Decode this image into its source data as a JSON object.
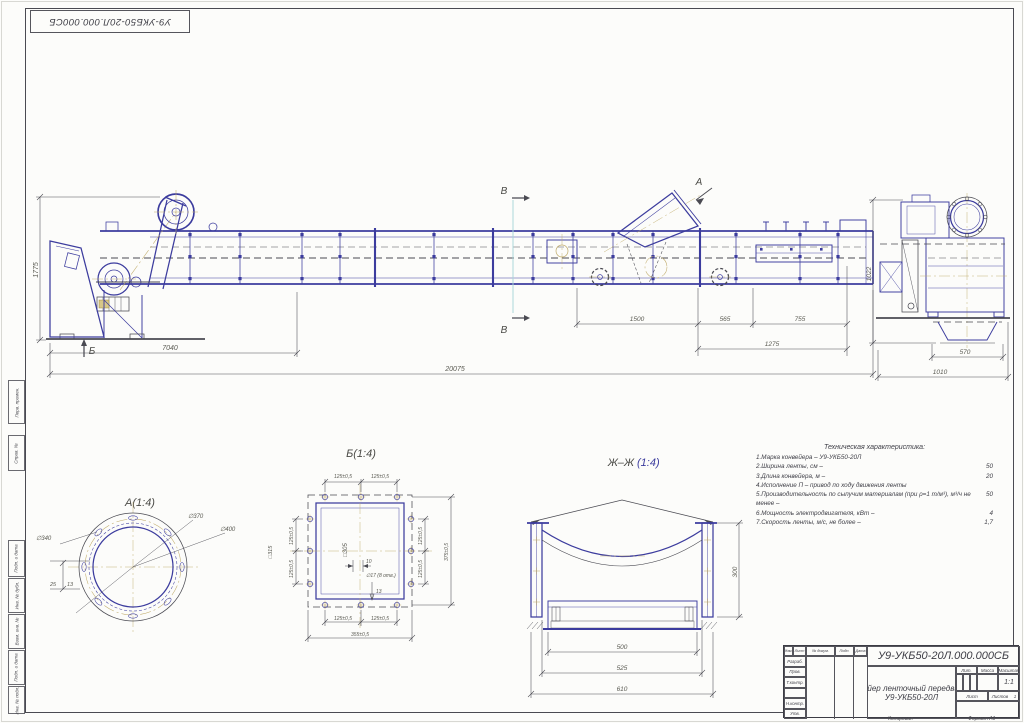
{
  "corner_stamp": {
    "number": "У9-УКБ50-20Л.000.000СБ"
  },
  "margin_stamps": [
    "Перв. примен.",
    "Справ. №",
    "Подп. и дата",
    "Инв. № дубл.",
    "Взам. инв. №",
    "Подп. и дата",
    "Инв. № подл."
  ],
  "main_view": {
    "label_a": "А",
    "label_b": "Б",
    "label_v_top": "В",
    "label_v_bottom": "В",
    "dim_drive": "7040",
    "dim_total": "20075",
    "dim_height": "1775",
    "dim_hopper1": "1500",
    "dim_hopper2": "565",
    "dim_tail": "755",
    "dim_tail_total": "1275"
  },
  "end_view": {
    "dim_height": "1022",
    "dim_width1": "570",
    "dim_width2": "1010"
  },
  "detail_a": {
    "title": "А(1:4)",
    "dia_bolt": "∅340",
    "dia_mid": "∅370",
    "dia_outer": "∅400",
    "dim_s1": "25",
    "dim_s2": "13"
  },
  "detail_b": {
    "title": "Б(1:4)",
    "pitch": "125±0,5",
    "total_w": "355±0,5",
    "total_h": "375±0,5",
    "sq_inner": "□305",
    "sq_outer": "□315",
    "dim_10": "10",
    "dim_13": "13",
    "holes": "∅17 (8 отв.)"
  },
  "section_zh": {
    "title": "Ж–Ж",
    "scale": "(1:4)",
    "dim_inner": "500",
    "dim_mid": "525",
    "dim_outer": "610",
    "dim_height": "300"
  },
  "tech": {
    "title": "Техническая характеристика:",
    "rows": [
      {
        "t": "1.Марка конвейера – У9-УКБ50-20Л",
        "v": ""
      },
      {
        "t": "2.Ширина ленты, см –",
        "v": "50"
      },
      {
        "t": "3.Длина конвейера, м –",
        "v": "20"
      },
      {
        "t": "4.Исполнение П – привод по ходу движения ленты",
        "v": ""
      },
      {
        "t": "5.Производительность по сыпучим материалам (при ρ=1 т/м³), м³/ч не менее –",
        "v": "50"
      },
      {
        "t": "6.Мощность электродвигателя, кВт –",
        "v": "4"
      },
      {
        "t": "7.Скорость ленты, м/с, не более –",
        "v": "1,7"
      }
    ]
  },
  "title_block": {
    "doc_number": "У9-УКБ50-20Л.000.000СБ",
    "name_line1": "Конвейер ленточный передвижной",
    "name_line2": "У9-УКБ50-20Л",
    "cols": [
      "Изм.",
      "Лист",
      "№ докум.",
      "Подп.",
      "Дата"
    ],
    "rows": [
      "Разраб.",
      "Пров.",
      "Т.контр.",
      "",
      "Н.контр.",
      "Утв."
    ],
    "lit": "Лит.",
    "massa": "Масса",
    "masshtab": "Масштаб",
    "scale_value": "1:1",
    "list_label": "Лист",
    "listov_label": "Листов",
    "listov_value": "1",
    "kopiroval": "Копировал",
    "format": "Формат А1"
  }
}
